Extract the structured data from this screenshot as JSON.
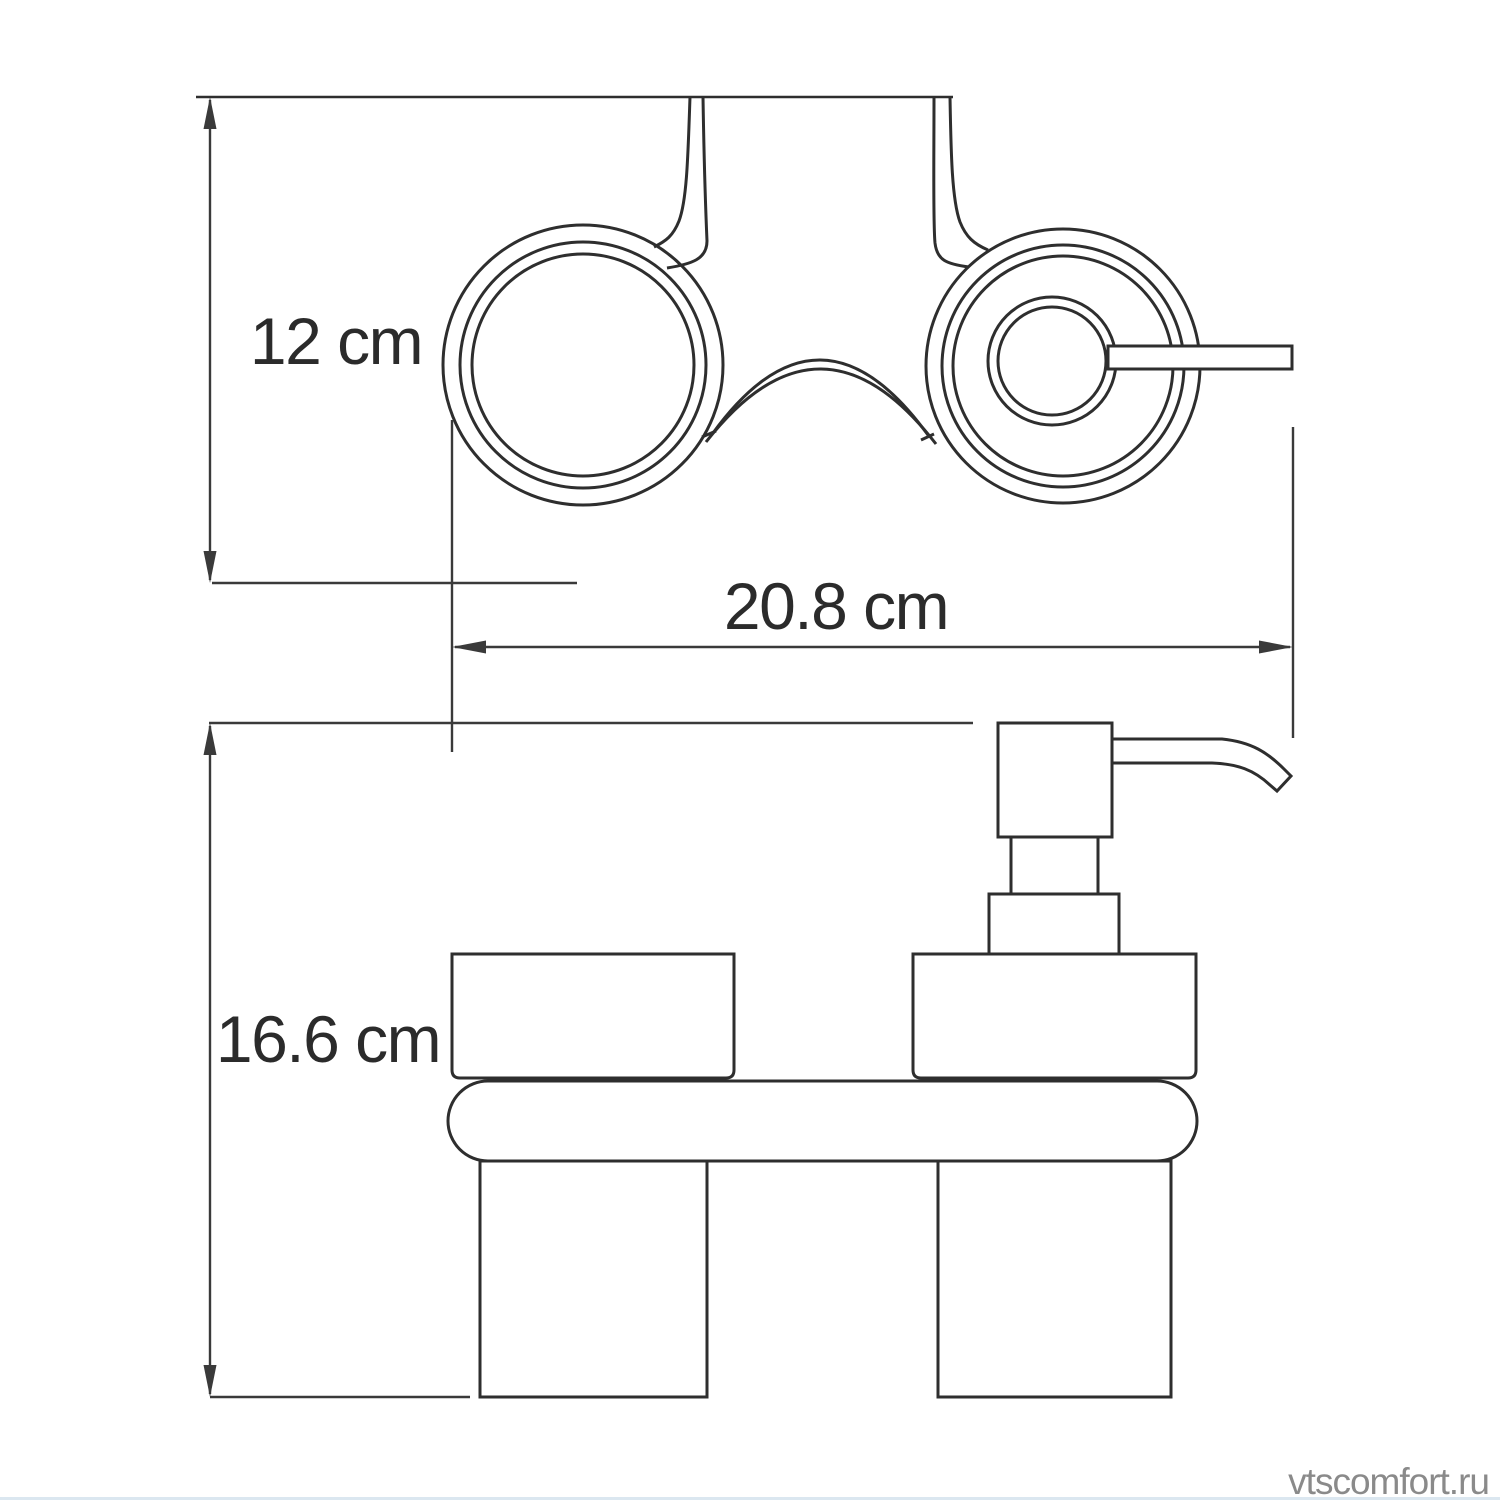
{
  "colors": {
    "background": "#ffffff",
    "line": "#2e2e2e",
    "dim": "#3a3a3a",
    "text": "#2b2b2b",
    "watermark": "#8a8a8a",
    "strip": "#dbe7f0"
  },
  "dimensions": {
    "depth": {
      "label": "12 cm",
      "value_cm": 12
    },
    "width": {
      "label": "20.8 cm",
      "value_cm": 20.8
    },
    "height": {
      "label": "16.6 cm",
      "value_cm": 16.6
    }
  },
  "watermark": {
    "text": "vtscomfort.ru"
  }
}
